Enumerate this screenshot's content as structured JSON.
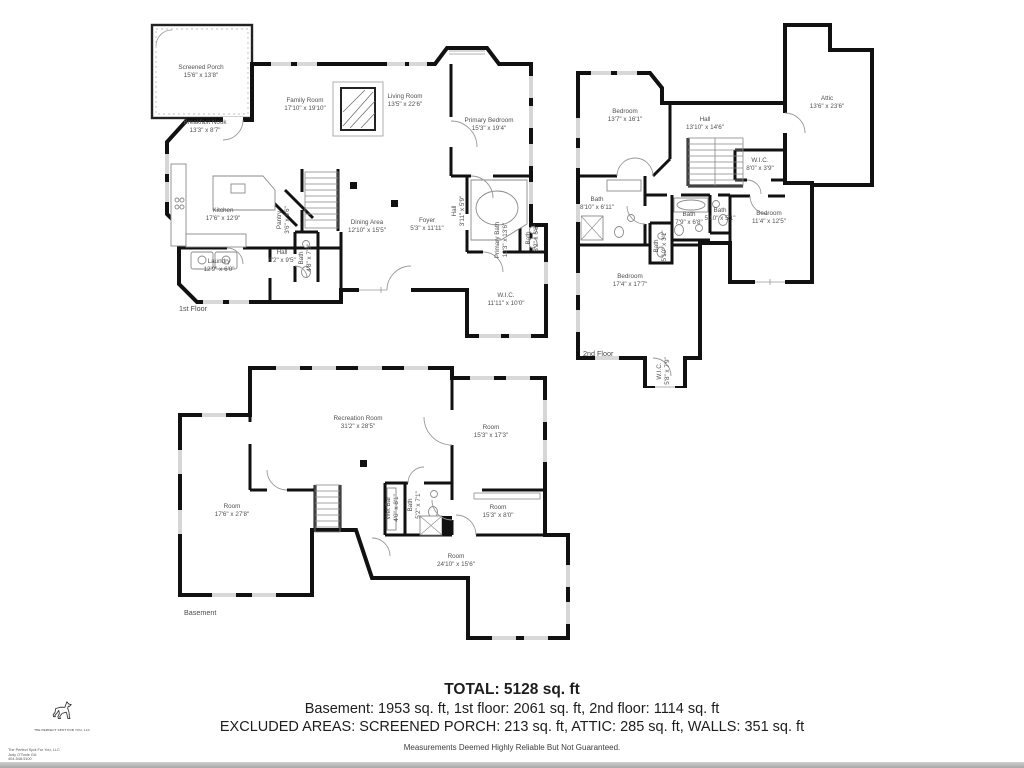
{
  "floors": {
    "first": {
      "label": "1st Floor",
      "rooms": [
        {
          "name": "Screened Porch",
          "dims": "15'6\" x 13'8\""
        },
        {
          "name": "Breakfast Nook",
          "dims": "13'3\" x 8'7\""
        },
        {
          "name": "Family Room",
          "dims": "17'10\" x 19'10\""
        },
        {
          "name": "Living Room",
          "dims": "13'5\" x 22'6\""
        },
        {
          "name": "Primary Bedroom",
          "dims": "15'3\" x 19'4\""
        },
        {
          "name": "Kitchen",
          "dims": "17'6\" x 12'9\""
        },
        {
          "name": "Pantry",
          "dims": "3'6\" x 8'6\""
        },
        {
          "name": "Dining Area",
          "dims": "12'10\" x 15'5\""
        },
        {
          "name": "Laundry",
          "dims": "12'9\" x 6'0\""
        },
        {
          "name": "Hall",
          "dims": "6'2\" x 9'5\""
        },
        {
          "name": "Bath",
          "dims": "4'8\" x 7'6\""
        },
        {
          "name": "Foyer",
          "dims": "5'3\" x 11'11\""
        },
        {
          "name": "Hall",
          "dims": "3'11\" x 5'9\""
        },
        {
          "name": "Primary Bath",
          "dims": "12'3\" x 13'6\""
        },
        {
          "name": "Bath",
          "dims": "3'2\" x 6'6\""
        },
        {
          "name": "W.I.C.",
          "dims": "11'11\" x 10'0\""
        }
      ]
    },
    "second": {
      "label": "2nd Floor",
      "rooms": [
        {
          "name": "Bedroom",
          "dims": "13'7\" x 16'1\""
        },
        {
          "name": "Hall",
          "dims": "13'10\" x 14'6\""
        },
        {
          "name": "Attic",
          "dims": "13'6\" x 23'6\""
        },
        {
          "name": "W.I.C.",
          "dims": "8'0\" x 3'9\""
        },
        {
          "name": "Bath",
          "dims": "8'10\" x 6'11\""
        },
        {
          "name": "Bedroom",
          "dims": "11'4\" x 12'5\""
        },
        {
          "name": "Bath",
          "dims": "7'9\" x 6'8\""
        },
        {
          "name": "Bath",
          "dims": "5'10\" x 5'1\""
        },
        {
          "name": "Bath",
          "dims": "5'10\" x 3'1\""
        },
        {
          "name": "Bedroom",
          "dims": "17'4\" x 17'7\""
        },
        {
          "name": "W.I.C.",
          "dims": "5'8\" x 7'9\""
        }
      ]
    },
    "basement": {
      "label": "Basement",
      "rooms": [
        {
          "name": "Recreation Room",
          "dims": "31'2\" x 28'5\""
        },
        {
          "name": "Room",
          "dims": "15'3\" x 17'3\""
        },
        {
          "name": "Room",
          "dims": "17'6\" x 27'8\""
        },
        {
          "name": "Wet Bar",
          "dims": "4'0\" x 8'1\""
        },
        {
          "name": "Bath",
          "dims": "5'2\" x 7'1\""
        },
        {
          "name": "Room",
          "dims": "15'3\" x 8'0\""
        },
        {
          "name": "Room",
          "dims": "24'10\" x 15'6\""
        }
      ]
    }
  },
  "summary": {
    "total": "TOTAL: 5128 sq. ft",
    "line2": "Basement: 1953 sq. ft, 1st floor: 2061 sq. ft, 2nd floor: 1114 sq. ft",
    "line3": "EXCLUDED AREAS: SCREENED PORCH: 213 sq. ft, ATTIC: 285 sq. ft, WALLS: 351 sq. ft",
    "disclaimer": "Measurements Deemed Highly Reliable But Not Guaranteed."
  },
  "branding": {
    "logo": "dog-silhouette",
    "company": "THE PERFECT SPOT FOR YOU, LLC",
    "footer_lines": [
      "The Perfect Spot For You, LLC",
      "Jody O'Toole GA",
      "404-548-5100"
    ]
  }
}
